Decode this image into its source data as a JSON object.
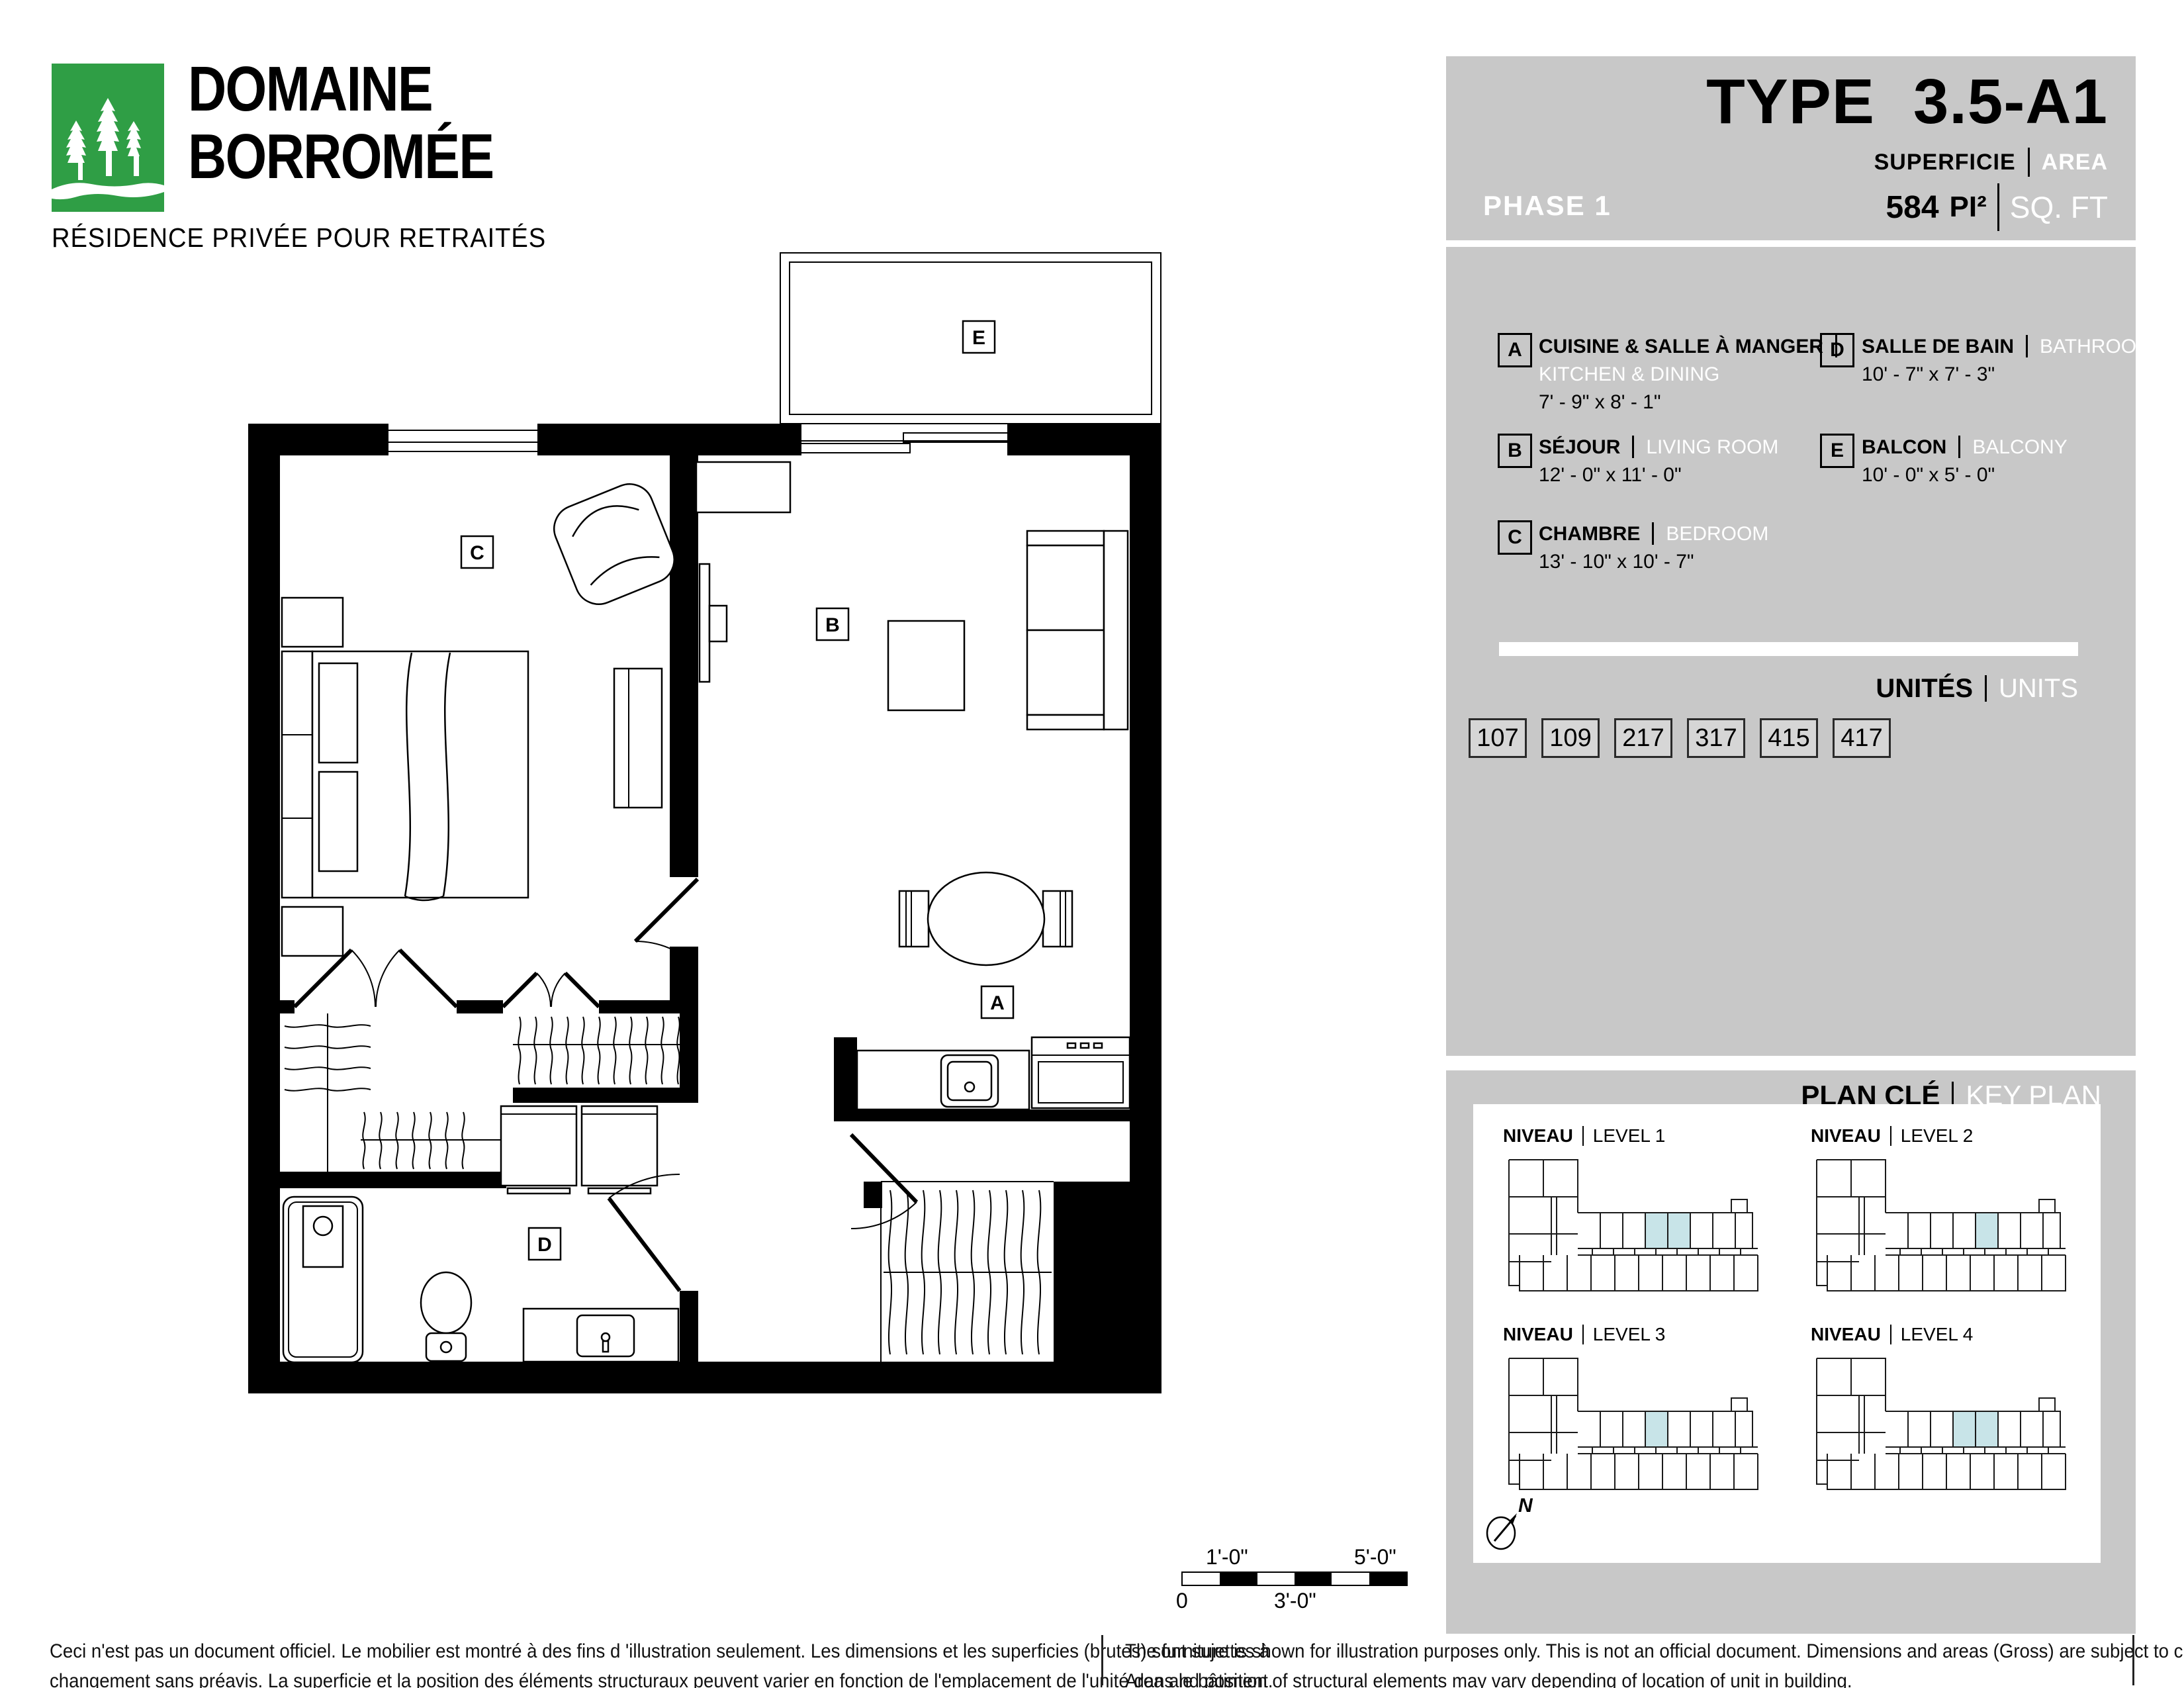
{
  "logo": {
    "line1": "DOMAINE",
    "line2": "BORROMÉE",
    "tagline": "RÉSIDENCE PRIVÉE POUR RETRAITÉS",
    "green": "#2f9e45"
  },
  "header": {
    "phase": "PHASE 1",
    "type_word": "TYPE",
    "type_code": "3.5-A1",
    "superficie": "SUPERFICIE",
    "area": "AREA",
    "value": "584",
    "unit_fr": "PI²",
    "unit_en": "SQ. FT"
  },
  "legend": {
    "items": [
      {
        "letter": "A",
        "fr": "CUISINE & SALLE À MANGER",
        "en": "KITCHEN & DINING",
        "dims": "7' - 9\" x 8' - 1\""
      },
      {
        "letter": "B",
        "fr": "SÉJOUR",
        "en": "LIVING ROOM",
        "dims": "12' - 0\" x 11' - 0\""
      },
      {
        "letter": "C",
        "fr": "CHAMBRE",
        "en": "BEDROOM",
        "dims": "13' - 10\" x 10' - 7\""
      },
      {
        "letter": "D",
        "fr": "SALLE DE BAIN",
        "en": "BATHROOM",
        "dims": "10' - 7\" x 7' - 3\""
      },
      {
        "letter": "E",
        "fr": "BALCON",
        "en": "BALCONY",
        "dims": "10' - 0\" x 5' - 0\""
      }
    ]
  },
  "units": {
    "label_fr": "UNITÉS",
    "label_en": "UNITS",
    "numbers": [
      "107",
      "109",
      "217",
      "317",
      "415",
      "417"
    ]
  },
  "keyplan": {
    "label_fr": "PLAN CLÉ",
    "label_en": "KEY PLAN",
    "niveau": "NIVEAU",
    "levels": [
      "LEVEL 1",
      "LEVEL 2",
      "LEVEL 3",
      "LEVEL 4"
    ],
    "compass": "N",
    "highlight_color": "#c8e4e8"
  },
  "plan": {
    "rooms": {
      "a": "A",
      "b": "B",
      "c": "C",
      "d": "D",
      "e": "E"
    }
  },
  "scalebar": {
    "top_left": "1'-0\"",
    "top_right": "5'-0\"",
    "bottom_left": "0",
    "bottom_mid": "3'-0\""
  },
  "disclaimer": {
    "fr1": "Ceci n'est pas un document officiel.  Le mobilier est montré à des fins d 'illustration seulement.  Les dimensions et les superficies (brutes) sont sujettes à",
    "fr2": "changement sans préavis. La superficie et la position des éléments structuraux peuvent varier en fonction de l'emplacement de l'unité dans le bâtiment.",
    "en1": "The furniture is shown for illustration purposes only.  This is not an official document.  Dimensions and areas (Gross) are subject to change without notice.",
    "en2": "Area and position of structural elements may vary depending of location of unit in building."
  }
}
